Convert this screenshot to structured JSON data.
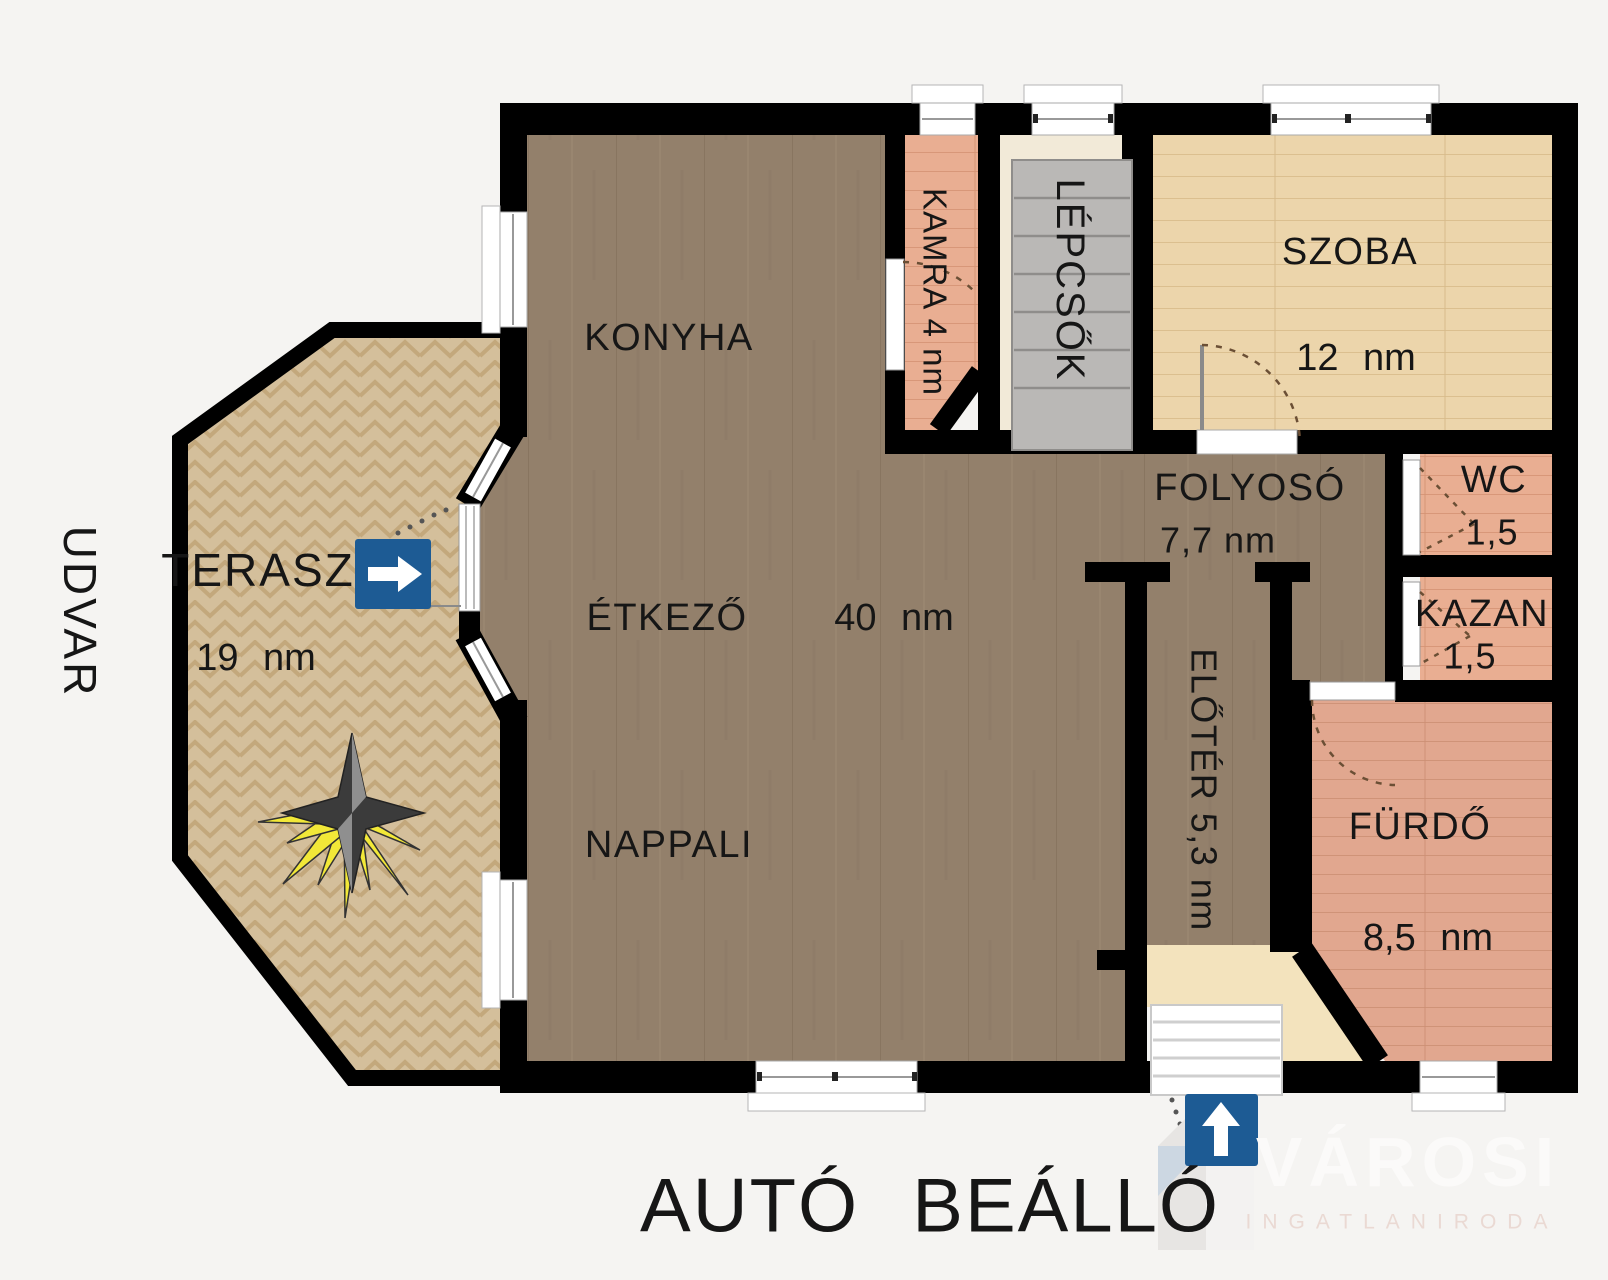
{
  "plan": {
    "rooms": {
      "konyha": {
        "label": "KONYHA"
      },
      "etkezo": {
        "label": "ÉTKEZŐ",
        "area": "40 nm"
      },
      "nappali": {
        "label": "NAPPALI"
      },
      "kamra": {
        "label": "KAMRA 4 nm"
      },
      "lepcsok": {
        "label": "LÉPCSŐK"
      },
      "szoba": {
        "label": "SZOBA",
        "area": "12 nm"
      },
      "folyoso": {
        "label": "FOLYOSÓ",
        "area": "7,7 nm"
      },
      "wc": {
        "label": "WC",
        "area": "1,5"
      },
      "kazan": {
        "label": "KAZAN",
        "area": "1,5"
      },
      "eloter": {
        "label": "ELŐTÉR 5,3 nm"
      },
      "furdo": {
        "label": "FÜRDŐ",
        "area": "8,5 nm"
      },
      "terasz": {
        "label": "TERASZ",
        "area": "19 nm"
      }
    },
    "outside": {
      "udvar": "UDVAR",
      "parking": "AUTÓ BEÁLLÓ"
    }
  },
  "watermark": {
    "brand": "VÁROSI",
    "subtitle": "INGATLANIRODA"
  },
  "icons": {
    "terrace_entrance": "arrow-right-icon",
    "main_entrance": "arrow-up-icon",
    "sun": "sun-star-icon",
    "stairs": "stairs-icon"
  },
  "colors": {
    "wall": "#000000",
    "floor_main": "#93806b",
    "terrace": "#d4bf9b",
    "room_szoba": "#ecd5ab",
    "pantry_salmon": "#e9ae92",
    "bath_pink": "#e1a78f",
    "stairs_gray": "#bab8b6",
    "landing_cream": "#f3e3bd",
    "accent_blue": "#1d5b94",
    "sun_yellow": "#f2e838"
  }
}
